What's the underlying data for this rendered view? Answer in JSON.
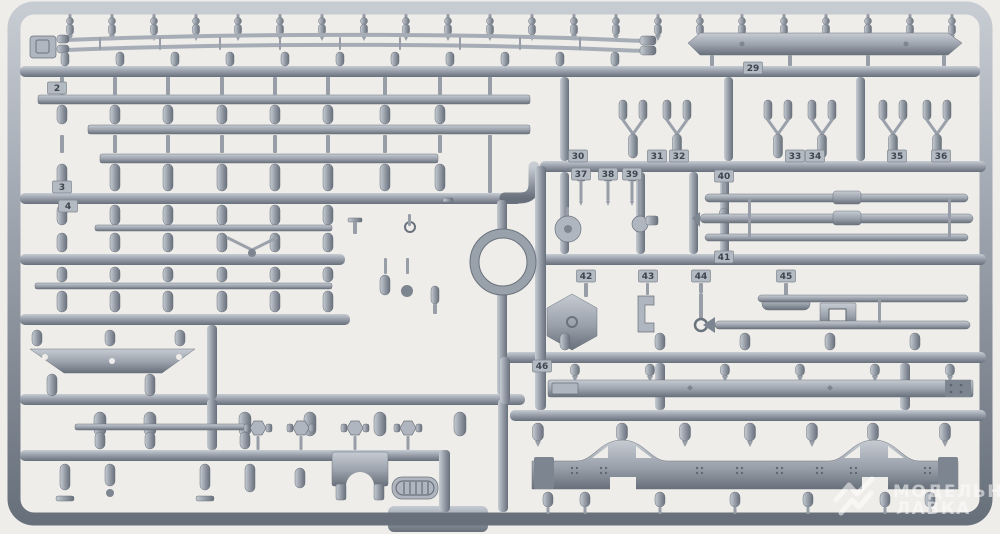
{
  "scene": {
    "background_color": "#efede9",
    "plastic_base": "#9aa1ab",
    "plastic_light": "#c7ccd3",
    "plastic_dark": "#68707b",
    "tag_plate": "#b4bac2",
    "tag_text": "#3e4550"
  },
  "part_tags": [
    {
      "label": "2",
      "x": 57,
      "y": 88
    },
    {
      "label": "3",
      "x": 62,
      "y": 187
    },
    {
      "label": "4",
      "x": 68,
      "y": 206
    },
    {
      "label": "29",
      "x": 753,
      "y": 68
    },
    {
      "label": "30",
      "x": 578,
      "y": 156
    },
    {
      "label": "31",
      "x": 657,
      "y": 156
    },
    {
      "label": "32",
      "x": 679,
      "y": 156
    },
    {
      "label": "33",
      "x": 795,
      "y": 156
    },
    {
      "label": "34",
      "x": 815,
      "y": 156
    },
    {
      "label": "35",
      "x": 897,
      "y": 156
    },
    {
      "label": "36",
      "x": 941,
      "y": 156
    },
    {
      "label": "37",
      "x": 581,
      "y": 174
    },
    {
      "label": "38",
      "x": 608,
      "y": 174
    },
    {
      "label": "39",
      "x": 632,
      "y": 174
    },
    {
      "label": "40",
      "x": 724,
      "y": 176
    },
    {
      "label": "41",
      "x": 724,
      "y": 257
    },
    {
      "label": "42",
      "x": 586,
      "y": 276
    },
    {
      "label": "43",
      "x": 648,
      "y": 276
    },
    {
      "label": "44",
      "x": 701,
      "y": 276
    },
    {
      "label": "45",
      "x": 786,
      "y": 276
    },
    {
      "label": "46",
      "x": 542,
      "y": 366
    }
  ],
  "watermark": {
    "line1": "МОДЕЛЬНАЯ",
    "line2": "ЛАВКА"
  }
}
